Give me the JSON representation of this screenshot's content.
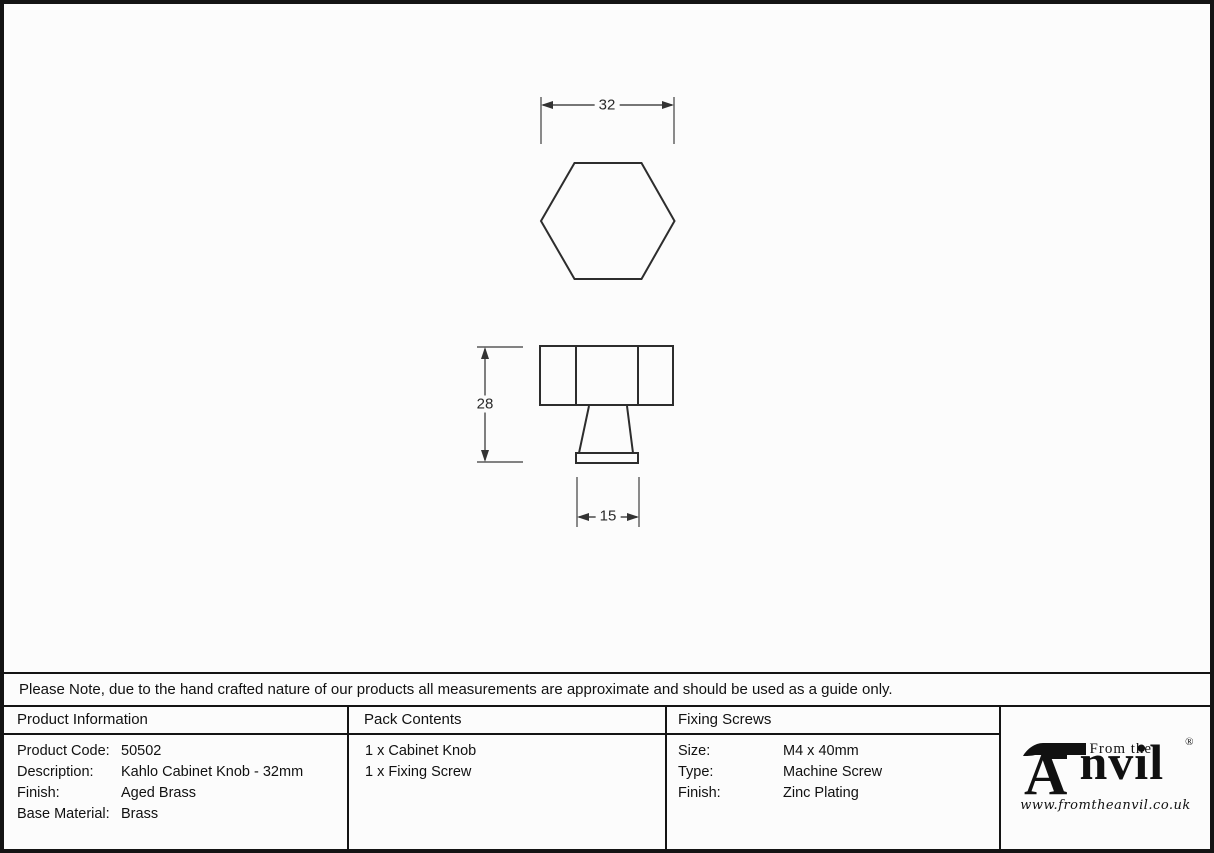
{
  "drawing": {
    "top_view_width_label": "32",
    "side_view_height_label": "28",
    "side_view_base_label": "15"
  },
  "note": {
    "text": "Please Note, due to the hand crafted nature of our products all measurements are approximate and should be used as a guide only."
  },
  "tables": {
    "product_information": {
      "header": "Product Information",
      "rows": [
        {
          "label": "Product Code:",
          "value": "50502"
        },
        {
          "label": "Description:",
          "value": "Kahlo Cabinet Knob - 32mm"
        },
        {
          "label": "Finish:",
          "value": "Aged Brass"
        },
        {
          "label": "Base Material:",
          "value": "Brass"
        }
      ]
    },
    "pack_contents": {
      "header": "Pack Contents",
      "items": [
        "1 x Cabinet Knob",
        "1 x Fixing Screw"
      ]
    },
    "fixing_screws": {
      "header": "Fixing Screws",
      "rows": [
        {
          "label": "Size:",
          "value": "M4 x 40mm"
        },
        {
          "label": "Type:",
          "value": "Machine Screw"
        },
        {
          "label": "Finish:",
          "value": "Zinc Plating"
        }
      ]
    }
  },
  "logo": {
    "tagline": "From the",
    "brand_rest": "nvil",
    "registered_mark": "®",
    "website": "www.fromtheanvil.co.uk"
  },
  "colors": {
    "ink": "#141414",
    "drawing_line": "#2d2d2d",
    "dimension_line": "#5a5a5a",
    "background": "#fcfcfc"
  }
}
